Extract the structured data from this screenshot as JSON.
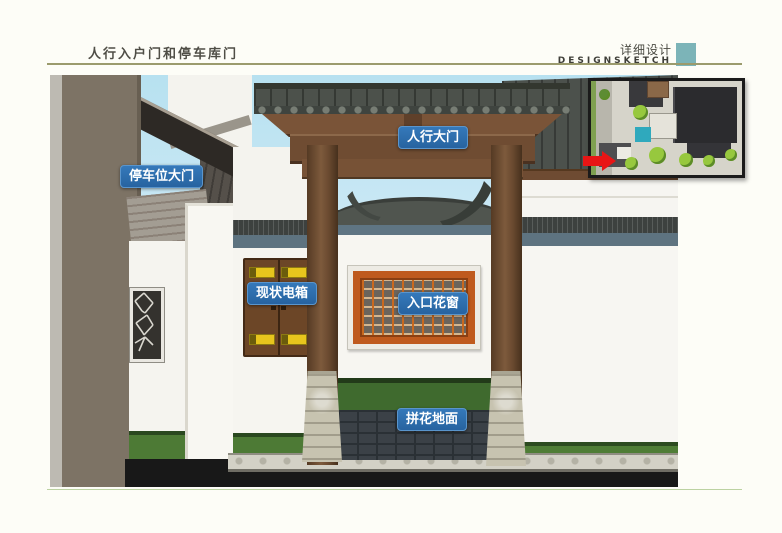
{
  "header": {
    "title": "人行入户门和停车库门",
    "subtitle_cn": "详细设计",
    "subtitle_en": "DESIGNSKETCH"
  },
  "annotations": {
    "pedestrian_gate": "人行大门",
    "parking_gate": "停车位大门",
    "existing_electric_box": "现状电箱",
    "entrance_lattice_window": "入口花窗",
    "mosaic_paving": "拼花地面"
  },
  "colors": {
    "accent_teal": "#7cb4b8",
    "annotation_blue": "#2b6cae",
    "header_rule_olive": "#9b9b6d",
    "footer_rule_green": "#bcd2a2",
    "locator_arrow_red": "#e81515"
  }
}
